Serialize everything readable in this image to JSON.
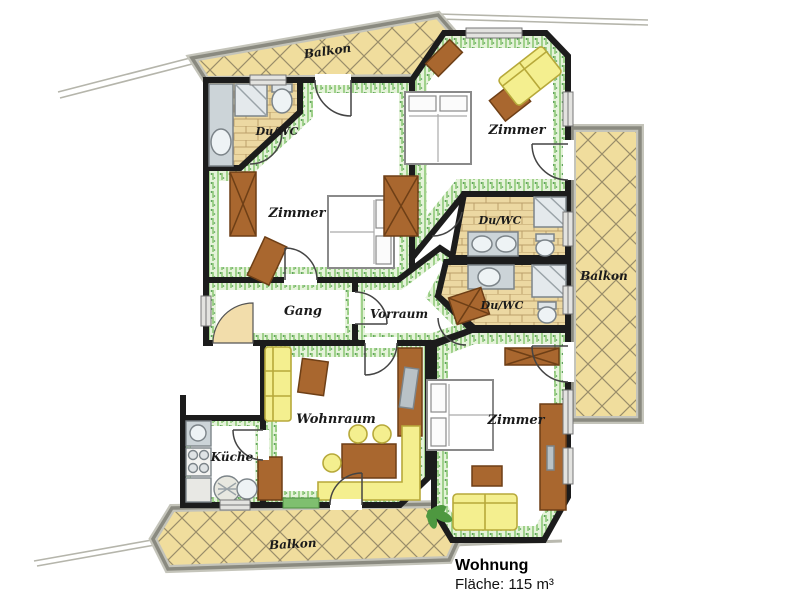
{
  "floorplan": {
    "labels": {
      "balkon_top": "Balkon",
      "zimmer_top_right": "Zimmer",
      "duwc_top_left": "Du/WC",
      "zimmer_left": "Zimmer",
      "gang": "Gang",
      "vorraum": "Vorraum",
      "duwc_right_upper": "Du/WC",
      "duwc_right_lower": "Du/WC",
      "balkon_right": "Balkon",
      "wohnraum": "Wohnraum",
      "kueche": "Küche",
      "zimmer_bottom_right": "Zimmer",
      "balkon_bottom": "Balkon"
    },
    "caption": {
      "title": "Wohnung",
      "area": "Fläche: 115 m³"
    },
    "colors": {
      "wall": "#1c1c1c",
      "balcony_fill": "#f0dd9d",
      "balcony_hatch": "#756b54",
      "railing": "#8a8a80",
      "tile_fill": "#ecd8a2",
      "tile_line": "#bb9f6b",
      "carpet_green": "#85c56d",
      "wood": "#a9672f",
      "wood_dark": "#6e3f16",
      "sofa_yellow": "#f4ef8f",
      "fixture_gray": "#ccd4d8",
      "floor_white": "#ffffff"
    }
  }
}
